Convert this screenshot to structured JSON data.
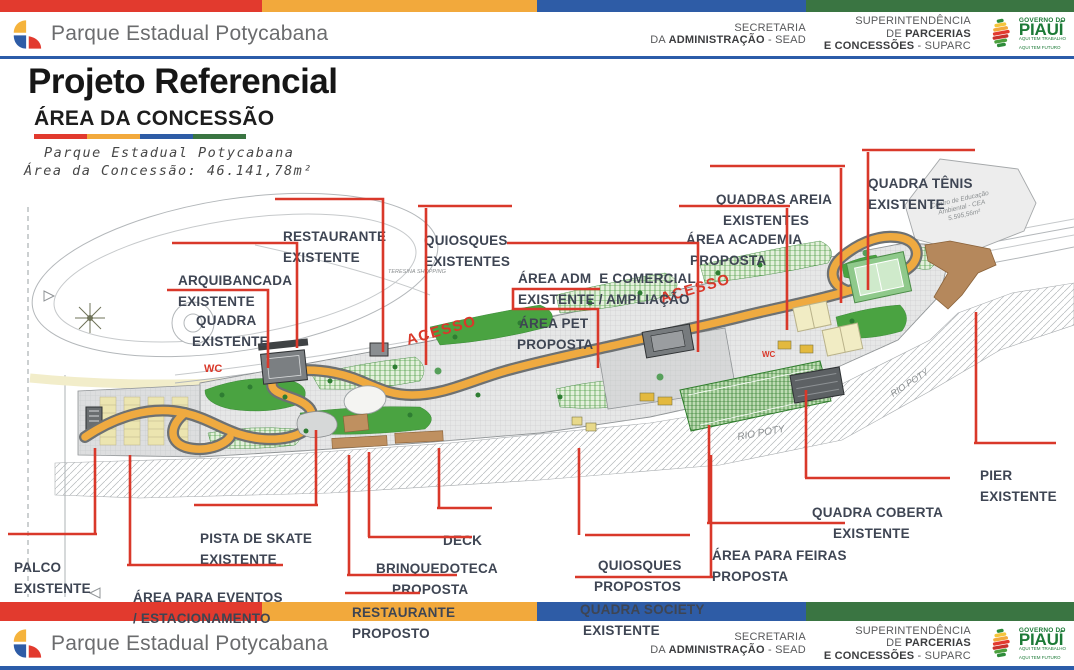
{
  "brand": {
    "title": "Parque Estadual Potycabana"
  },
  "org": {
    "secretaria_line1": "SECRETARIA",
    "secretaria_line2_pre": "DA ",
    "secretaria_line2_bold": "ADMINISTRAÇÃO",
    "secretaria_line2_post": " - SEAD",
    "suparc_line1": "SUPERINTENDÊNCIA",
    "suparc_line2_pre": "DE ",
    "suparc_line2_bold": "PARCERIAS",
    "suparc_line3_bold": "E CONCESSÕES",
    "suparc_line3_post": " - SUPARC",
    "governo_small": "GOVERNO DO",
    "governo_name": "PIAUÍ",
    "governo_tag1": "AQUI TEM TRABALHO",
    "governo_tag2": "AQUI TEM FUTURO"
  },
  "title_block": {
    "title": "Projeto Referencial",
    "subtitle": "ÁREA DA CONCESSÃO",
    "caption_line1": "Parque Estadual Potycabana",
    "caption_line2": "Área da Concessão: 46.141,78m²"
  },
  "palette": {
    "red": "#e23a2e",
    "yellow": "#f2a93c",
    "blue": "#2e5ca6",
    "green": "#3a7542",
    "leader_red": "#d9382a",
    "label_text": "#3e4553"
  },
  "map": {
    "labels": [
      {
        "id": "restaurante-existente",
        "line1": "RESTAURANTE",
        "line2": "EXISTENTE"
      },
      {
        "id": "arquibancada-existente",
        "line1": "ARQUIBANCADA",
        "line2": "EXISTENTE"
      },
      {
        "id": "quadra-existente",
        "line1": "QUADRA",
        "line2": "EXISTENTE"
      },
      {
        "id": "quiosques-existentes",
        "line1": "QUIOSQUES",
        "line2": "EXISTENTES"
      },
      {
        "id": "area-adm-comercial",
        "line1": "ÁREA ADM  E COMERCIAL",
        "line2": "EXISTENTE / AMPLIAÇÃO"
      },
      {
        "id": "area-pet",
        "line1": "ÁREA PET",
        "line2": "PROPOSTA"
      },
      {
        "id": "quadras-areia",
        "line1": "QUADRAS AREIA",
        "line2": "EXISTENTES"
      },
      {
        "id": "area-academia",
        "line1": "ÁREA ACADEMIA",
        "line2": "PROPOSTA"
      },
      {
        "id": "quadra-tenis",
        "line1": "QUADRA TÊNIS",
        "line2": "EXISTENTE"
      },
      {
        "id": "pier-existente",
        "line1": "PIER",
        "line2": "EXISTENTE"
      },
      {
        "id": "quadra-coberta",
        "line1": "QUADRA COBERTA",
        "line2": "EXISTENTE"
      },
      {
        "id": "area-feiras",
        "line1": "ÁREA PARA FEIRAS",
        "line2": "PROPOSTA"
      },
      {
        "id": "quiosques-propostos",
        "line1": "QUIOSQUES",
        "line2": "PROPOSTOS"
      },
      {
        "id": "quadra-society",
        "line1": "QUADRA SOCIETY",
        "line2": "EXISTENTE"
      },
      {
        "id": "brinquedoteca-proposta",
        "line1": "BRINQUEDOTECA",
        "line2": "PROPOSTA"
      },
      {
        "id": "restaurante-proposto",
        "line1": "RESTAURANTE",
        "line2": "PROPOSTO"
      },
      {
        "id": "deck",
        "line1": "DECK",
        "line2": ""
      },
      {
        "id": "pista-skate",
        "line1": "PISTA DE SKATE",
        "line2": "EXISTENTE"
      },
      {
        "id": "palco-existente",
        "line1": "PALCO",
        "line2": "EXISTENTE"
      },
      {
        "id": "area-eventos",
        "line1": "ÁREA PARA EVENTOS",
        "line2": "/ ESTACIONAMENTO"
      }
    ],
    "texts": {
      "acesso": "ACESSO",
      "wc": "WC",
      "rio_poty": "RIO POTY",
      "teresina_shopping": "TERESINA SHOPPING",
      "cea_line1": "Centro de Educação",
      "cea_line2": "Ambiental - CEA",
      "cea_line3": "5.595,56m²"
    }
  }
}
